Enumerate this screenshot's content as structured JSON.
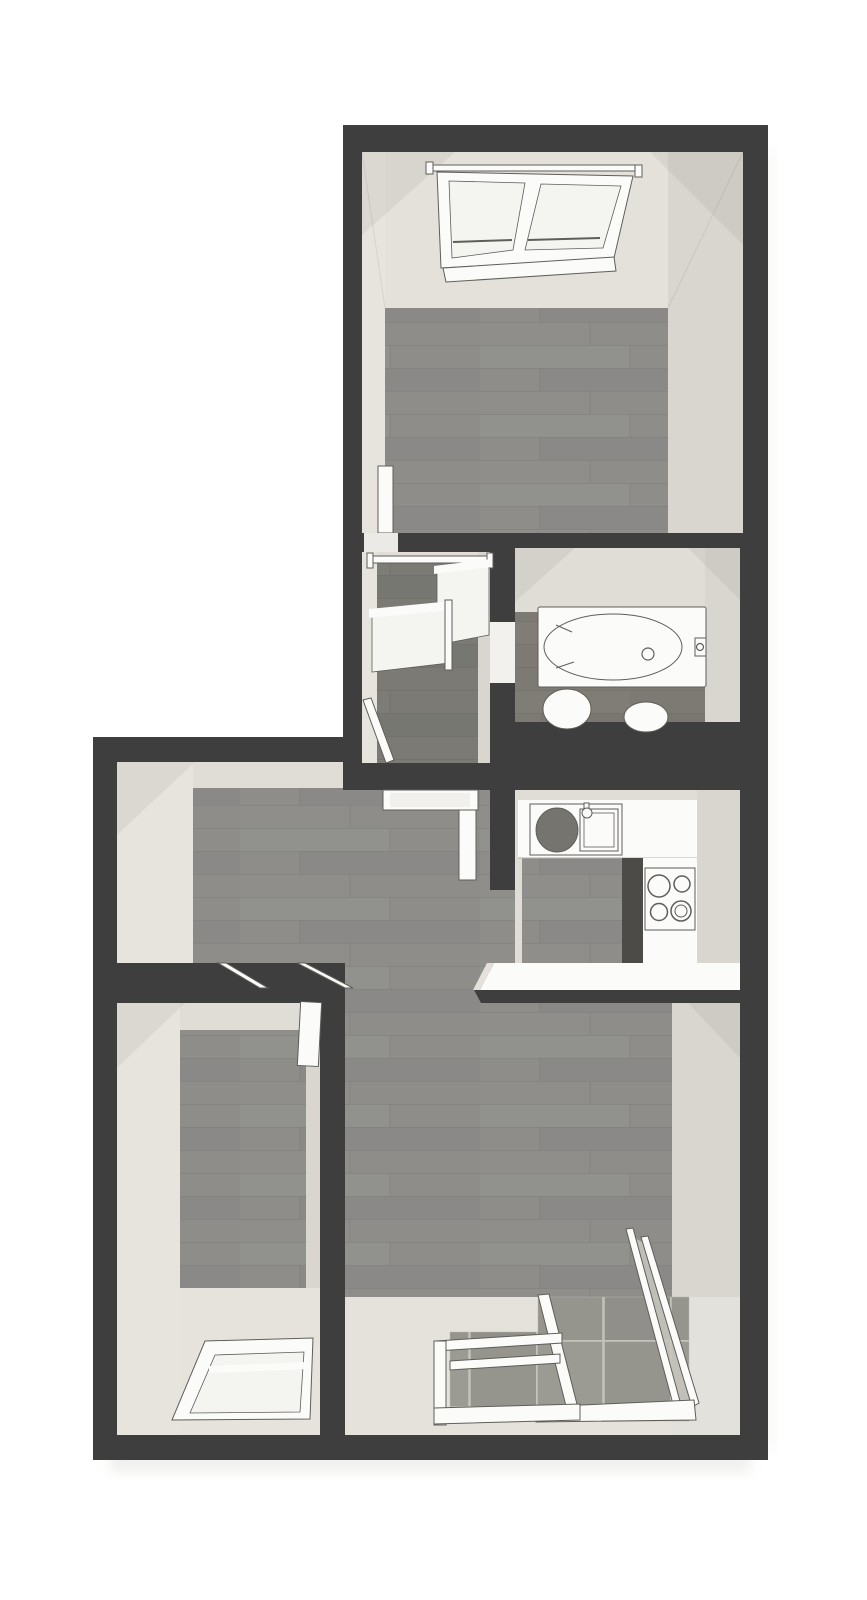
{
  "meta": {
    "title": "apartment-floor-plan",
    "type": "floor-plan",
    "style": "3d-top-down-render",
    "width_px": 867,
    "height_px": 1600,
    "visible_text": ""
  },
  "palette": {
    "background": "#ffffff",
    "wall": "#3e3e3e",
    "wall_face": "#dfddd5",
    "wall_face_light": "#e6e4dd",
    "wall_face_dark": "#d8d6cf",
    "floor_wood": "#8e8d8a",
    "floor_wood_dark": "#7b7a75",
    "floor_bath": "#7d7a73",
    "floor_tile": "#95948d",
    "tile_grout": "#c4c3bb",
    "fixture_fill": "#fbfbfa",
    "fixture_line": "#5f5e59",
    "counter_shadow": "#4c4b48",
    "sink_basin": "#75746f",
    "glass": "#c8c7c0",
    "drop_shadow": "#ecebe8"
  },
  "rooms": [
    {
      "id": "bedroom-top",
      "floor": "wood",
      "fixtures": [
        "skylight-window",
        "open-door-leaf",
        "door-threshold"
      ]
    },
    {
      "id": "stair-landing",
      "floor": "wood-dark",
      "fixtures": [
        "stair-railing-top",
        "stair-railing-panels",
        "stair-railing-lower"
      ]
    },
    {
      "id": "bathroom",
      "floor": "wood-bath",
      "fixtures": [
        "bathtub",
        "tub-faucet",
        "toilet",
        "washbasin",
        "door-opening"
      ]
    },
    {
      "id": "kitchen",
      "floor": "wood",
      "fixtures": [
        "countertop",
        "kitchen-sink-unit",
        "sink-basin",
        "faucet",
        "cooktop",
        "half-wall"
      ]
    },
    {
      "id": "hallway",
      "floor": "wood",
      "fixtures": [
        "door-frame",
        "door-leaf"
      ]
    },
    {
      "id": "bedroom-bottom",
      "floor": "wood",
      "fixtures": [
        "skylight-window",
        "door-leaf",
        "door-frame-posts"
      ]
    },
    {
      "id": "living-room",
      "floor": "wood",
      "fixtures": [
        "balcony-window-frames"
      ]
    },
    {
      "id": "balcony",
      "floor": "tile",
      "fixtures": [
        "glass-balustrade",
        "balustrade-rails",
        "bottom-rail"
      ]
    }
  ]
}
